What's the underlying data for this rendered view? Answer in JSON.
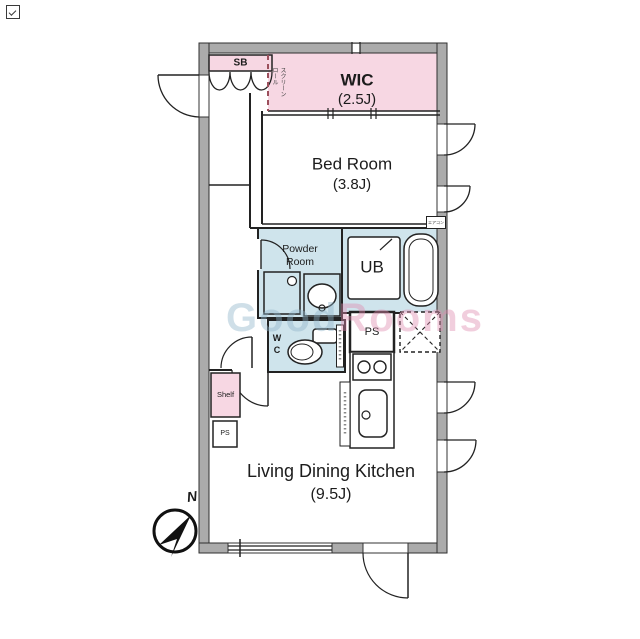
{
  "floorplan": {
    "rooms": {
      "wic": {
        "name": "WIC",
        "size": "(2.5J)"
      },
      "bedroom": {
        "name": "Bed Room",
        "size": "(3.8J)"
      },
      "ldk": {
        "name": "Living Dining Kitchen",
        "size": "(9.5J)"
      },
      "powder_room": {
        "line1": "Powder",
        "line2": "Room"
      },
      "unit_bath": "UB",
      "wc": {
        "line1": "W",
        "line2": "C"
      }
    },
    "labels": {
      "shoe_box": "SB",
      "shelf": "Shelf",
      "pipe_space_kitchen": "PS",
      "pipe_space_hall": "PS",
      "roll_screen_col1": "ロール",
      "roll_screen_col2": "スクリーン",
      "air_conditioner": "エアコン",
      "compass_north": "N"
    },
    "watermark": {
      "part1": "Good",
      "part2": "Rooms"
    },
    "colors": {
      "closet_pink": "#f7d7e3",
      "wet_area_blue": "#cfe4ec",
      "wall_gray": "#ababab",
      "line": "#222222",
      "roll_screen_dash": "#9c4f5c",
      "watermark_blue": "#8fb4c9",
      "watermark_pink": "#e08cb0"
    }
  }
}
